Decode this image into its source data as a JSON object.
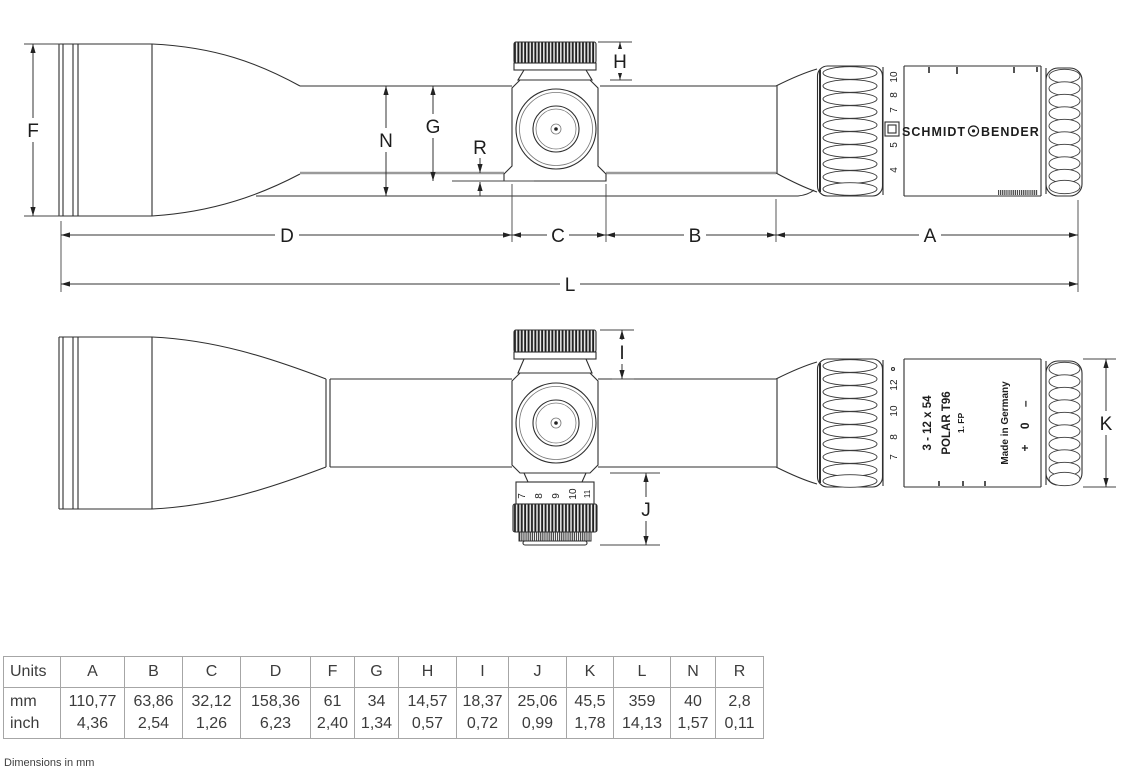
{
  "footnote": "Dimensions in mm",
  "side_view": {
    "dims": {
      "F": "F",
      "N": "N",
      "G": "G",
      "R": "R",
      "H": "H",
      "D": "D",
      "C": "C",
      "B": "B",
      "A": "A",
      "L": "L"
    },
    "brand_left": "SCHMIDT",
    "brand_right": "BENDER",
    "zoom_scale": [
      "4",
      "5",
      "7",
      "8",
      "10"
    ]
  },
  "top_view": {
    "dims": {
      "I": "I",
      "J": "J",
      "K": "K"
    },
    "zoom_scale": [
      "7",
      "8",
      "10",
      "12"
    ],
    "parallax_scale": [
      "7",
      "8",
      "9",
      "10",
      "11"
    ],
    "model": {
      "line1": "3 - 12 x 54",
      "line2": "POLAR T96",
      "line3": "1. FP"
    },
    "made_in": "Made in Germany",
    "diopter_marks": "+ 0 –"
  },
  "table": {
    "header": [
      "Units",
      "A",
      "B",
      "C",
      "D",
      "F",
      "G",
      "H",
      "I",
      "J",
      "K",
      "L",
      "N",
      "R"
    ],
    "unit_labels": {
      "mm": "mm",
      "inch": "inch"
    },
    "mm": [
      "110,77",
      "63,86",
      "32,12",
      "158,36",
      "61",
      "34",
      "14,57",
      "18,37",
      "25,06",
      "45,5",
      "359",
      "40",
      "2,8"
    ],
    "inch": [
      "4,36",
      "2,54",
      "1,26",
      "6,23",
      "2,40",
      "1,34",
      "0,57",
      "0,72",
      "0,99",
      "1,78",
      "14,13",
      "1,57",
      "0,11"
    ]
  }
}
